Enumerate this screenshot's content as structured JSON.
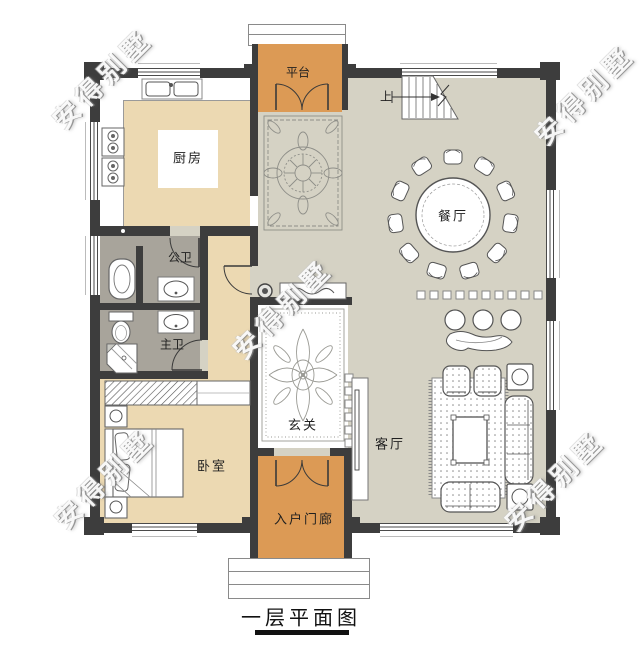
{
  "plan": {
    "title": "一层平面图",
    "watermark": "安得别墅",
    "stairs": {
      "label": "上"
    },
    "rooms": {
      "platform": {
        "label": "平台"
      },
      "kitchen": {
        "label": "厨房"
      },
      "dining": {
        "label": "餐厅"
      },
      "public_bath": {
        "label": "公卫"
      },
      "master_bath": {
        "label": "主卫"
      },
      "bedroom": {
        "label": "卧室"
      },
      "foyer": {
        "label": "玄关"
      },
      "living": {
        "label": "客厅"
      },
      "porch": {
        "label": "入户门廊"
      }
    },
    "colors": {
      "wall": "#3d3d3d",
      "terrace_orange": "#dc9a55",
      "wood_floor_tan": "#ecd9b2",
      "tile_gray": "#d5d2c4",
      "bath_gray": "#a8a49b"
    }
  }
}
